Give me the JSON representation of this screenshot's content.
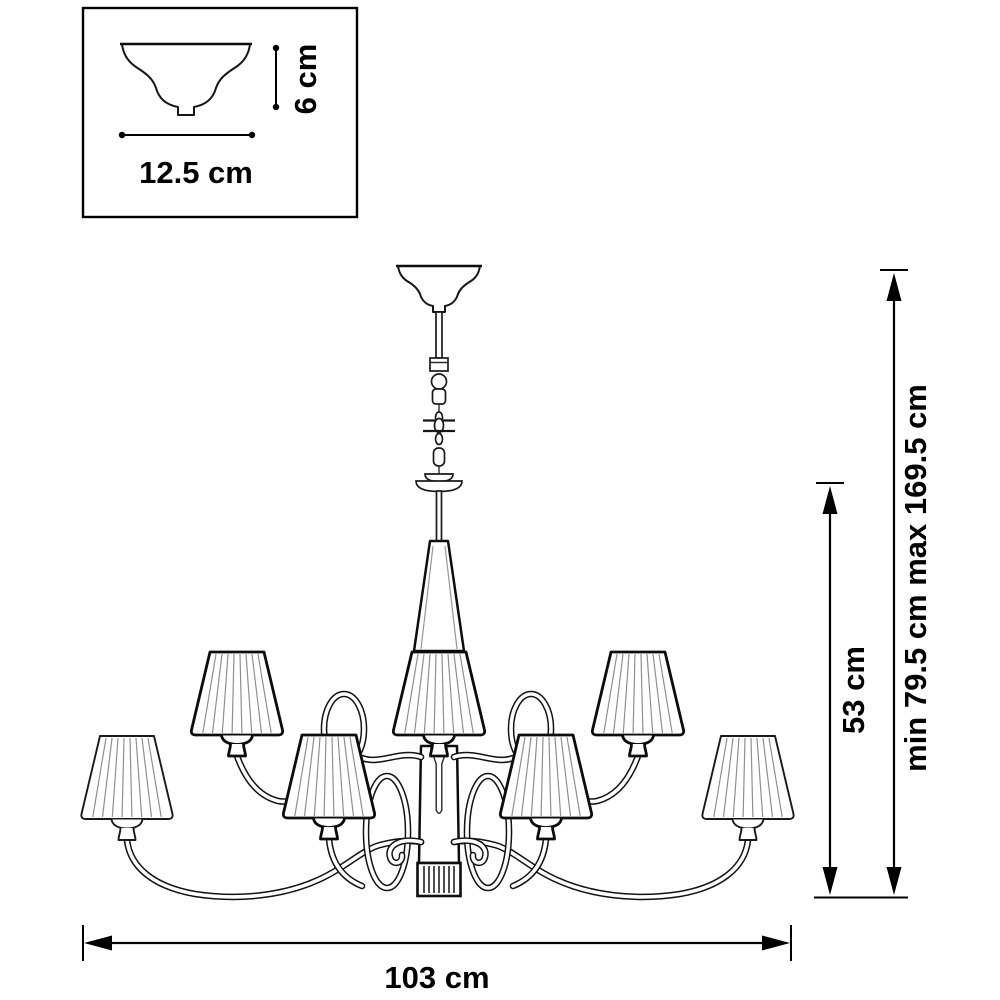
{
  "page": {
    "background": "#ffffff",
    "line_color": "#111111",
    "description": "Technical dimension drawing of a 6-arm chandelier with pleated cone shades and a central shade on a chain suspension"
  },
  "inset": {
    "height_label": "6 cm",
    "width_label": "12.5 cm"
  },
  "dimensions": {
    "body_height_label": "53 cm",
    "overall_height_label": "min 79.5 cm max 169.5 cm",
    "width_label": "103 cm"
  },
  "figure": {
    "shade_count": 7,
    "arm_count": 6
  }
}
